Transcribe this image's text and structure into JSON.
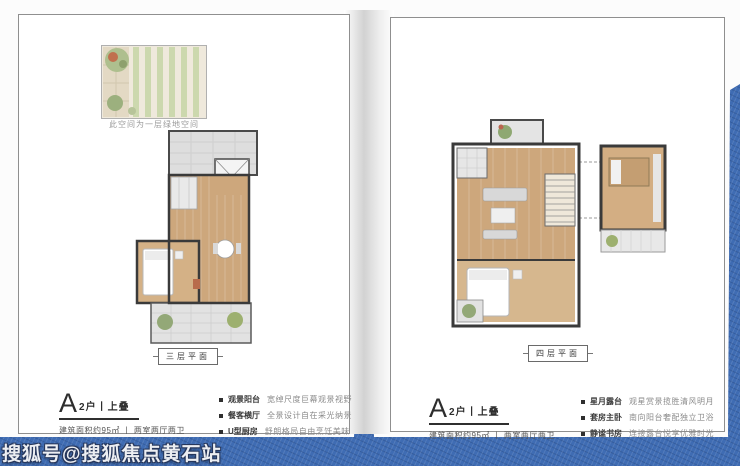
{
  "page": {
    "watermark": "搜狐号@搜狐焦点黄石站",
    "colors": {
      "background_blue": "#3f6cb3",
      "wood_floor": "#cda77c",
      "tile_gray": "#e0e0e0",
      "plant_green": "#93a877",
      "wall_dark": "#3a3a3a"
    }
  },
  "cards": [
    {
      "roof_garden_note": "此空间为一层绿地空间",
      "plan_label": "三层平面",
      "unit": {
        "type_letter": "A",
        "type_suffix": "2户丨上叠",
        "area_line": "建筑面积约95㎡ 丨 两室两厅两卫"
      },
      "features": [
        {
          "name": "观景阳台",
          "desc": "宽绰尺度巨幕观景视野"
        },
        {
          "name": "餐客横厅",
          "desc": "全景设计自在采光纳景"
        },
        {
          "name": "U型厨房",
          "desc": "舒朗格局自由烹饪美味"
        }
      ]
    },
    {
      "plan_label": "四层平面",
      "unit": {
        "type_letter": "A",
        "type_suffix": "2户丨上叠",
        "area_line": "建筑面积约95㎡ 丨 两室两厅两卫"
      },
      "features": [
        {
          "name": "星月露台",
          "desc": "观星赏景揽胜清风明月"
        },
        {
          "name": "套房主卧",
          "desc": "南向阳台奢配独立卫浴"
        },
        {
          "name": "静谧书房",
          "desc": "连接露台悦享优雅时光"
        }
      ]
    }
  ]
}
